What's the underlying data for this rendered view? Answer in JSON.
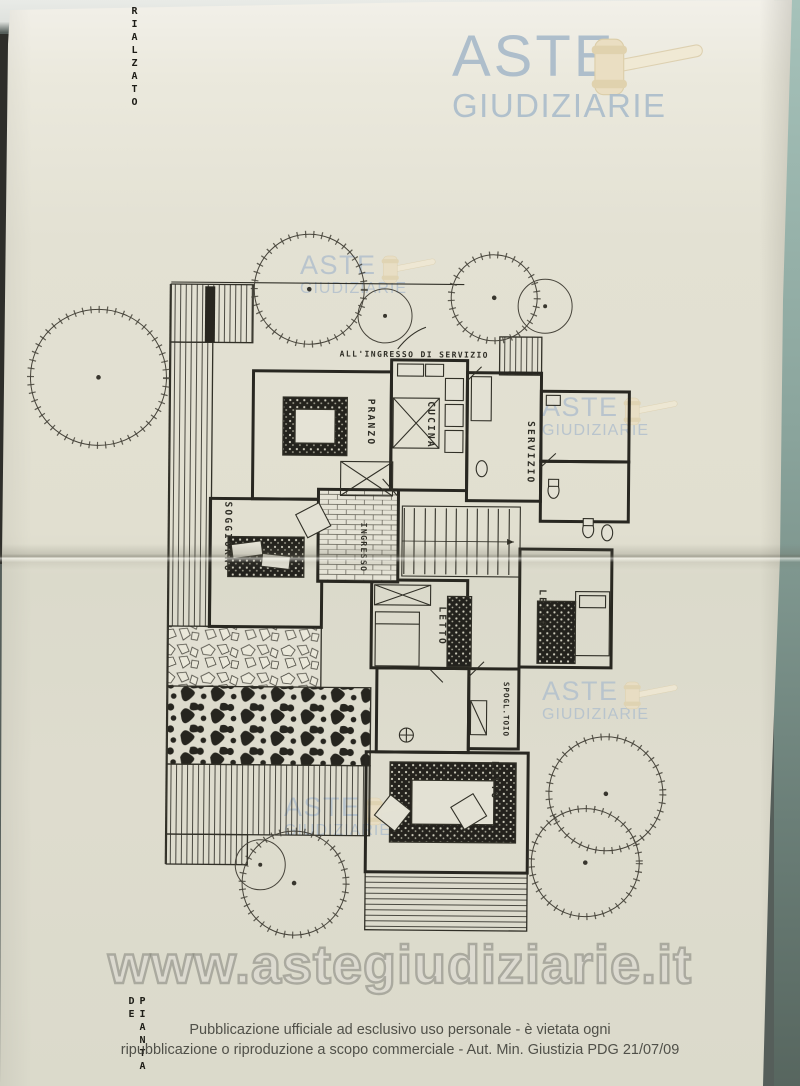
{
  "branding": {
    "logo_line1": "ASTE",
    "logo_line2": "GIUDIZIARIE",
    "url_watermark": "www.astegiudiziarie.it",
    "logo_color": "#a9bbca",
    "gavel_color": "#eadec2"
  },
  "handwritten": {
    "top_left_vertical": "RIALZATO",
    "bottom_left_vertical": "PIANTA DE"
  },
  "plan": {
    "service_entrance_label": "ALL'INGRESSO DI SERVIZIO",
    "rooms": [
      {
        "label": "PRANZO"
      },
      {
        "label": "CUCINA"
      },
      {
        "label": "SERVIZIO"
      },
      {
        "label": "SOGGIORNO"
      },
      {
        "label": "INGRESSO"
      },
      {
        "label": "LETTO"
      },
      {
        "label": "LETTO"
      },
      {
        "label": "SPOGL.TOIO"
      },
      {
        "label": "LETTO"
      }
    ]
  },
  "footer": {
    "line1": "Pubblicazione ufficiale ad esclusivo uso personale - è vietata ogni",
    "line2": "ripubblicazione o riproduzione a scopo commerciale - Aut. Min. Giustizia PDG 21/07/09"
  }
}
